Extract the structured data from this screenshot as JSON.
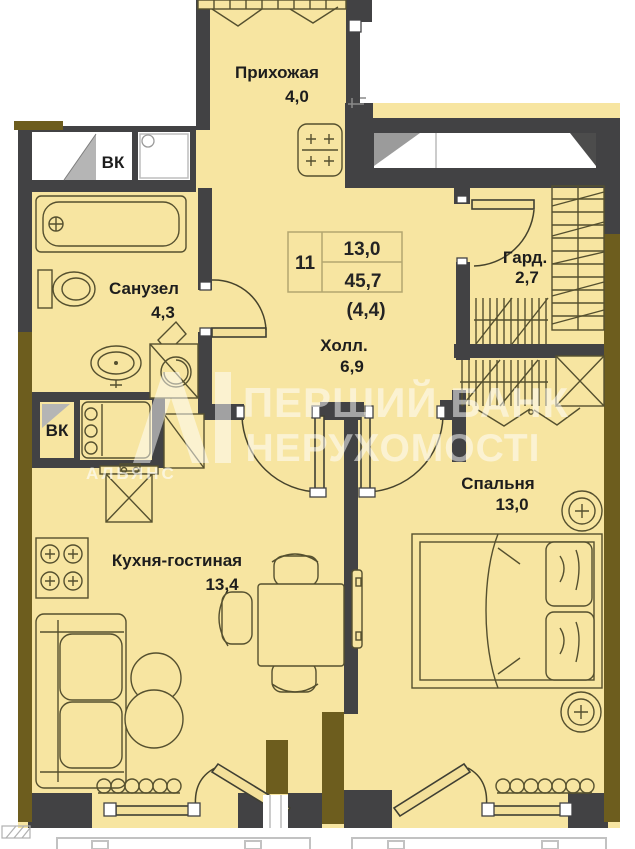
{
  "plan": {
    "info_table": {
      "unit_number": "11",
      "living_area": "13,0",
      "total_area": "45,7",
      "extra_area": "(4,4)"
    },
    "rooms": {
      "hallway": {
        "name": "Прихожая",
        "area": "4,0"
      },
      "bathroom": {
        "name": "Санузел",
        "area": "4,3"
      },
      "hall": {
        "name": "Холл.",
        "area": "6,9"
      },
      "wardrobe": {
        "name": "Гард.",
        "area": "2,7"
      },
      "bedroom": {
        "name": "Спальня",
        "area": "13,0"
      },
      "kitchen_living": {
        "name": "Кухня-гостиная",
        "area": "13,4"
      }
    },
    "shafts": {
      "vk_top": "ВК",
      "vk_kitchen": "ВК"
    }
  },
  "watermark": {
    "line1": "ПЕРШИЙ БАНК",
    "line2": "НЕРУХОМОСТІ",
    "logo_text": "АЛЬЯНС"
  },
  "colors": {
    "floor": "#f7e5a1",
    "interior_wall": "#424244",
    "exterior_wall": "#6d5d1e",
    "furniture_line": "#55502f",
    "watermark": "#ffffff"
  }
}
